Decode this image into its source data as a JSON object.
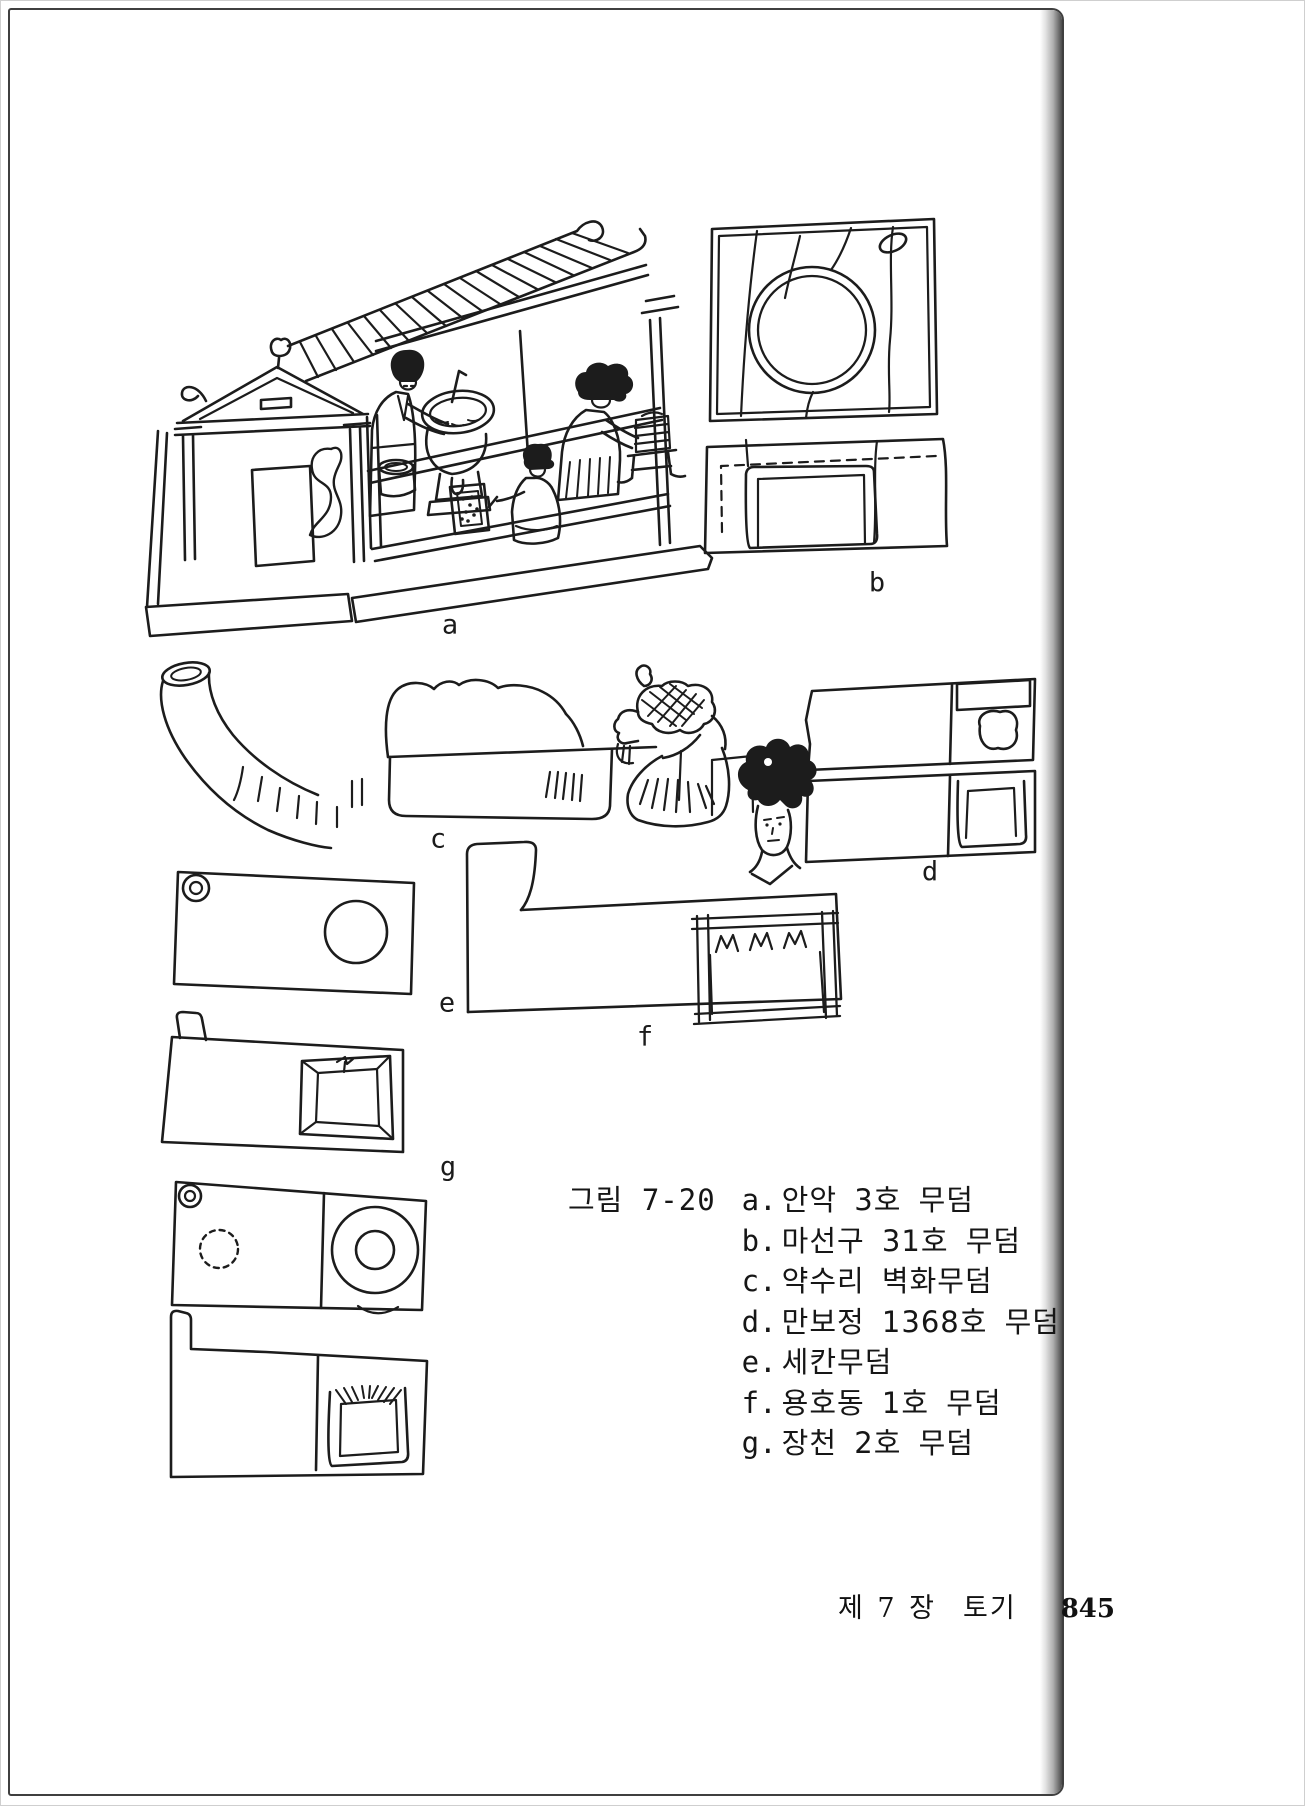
{
  "figure": {
    "number": "그림 7-20",
    "drawing_labels": [
      "a",
      "b",
      "c",
      "d",
      "e",
      "f",
      "g"
    ],
    "caption_entries": [
      {
        "key": "a.",
        "text": "안악 3호 무덤"
      },
      {
        "key": "b.",
        "text": "마선구 31호 무덤"
      },
      {
        "key": "c.",
        "text": "약수리 벽화무덤"
      },
      {
        "key": "d.",
        "text": "만보정 1368호 무덤"
      },
      {
        "key": "e.",
        "text": "세칸무덤"
      },
      {
        "key": "f.",
        "text": "용호동 1호 무덤"
      },
      {
        "key": "g.",
        "text": "장천 2호 무덤"
      }
    ]
  },
  "footer": {
    "chapter": "제 7 장",
    "section": "토기",
    "page_number": "845"
  },
  "colors": {
    "ink": "#1c1c1c",
    "paper": "#ffffff"
  }
}
